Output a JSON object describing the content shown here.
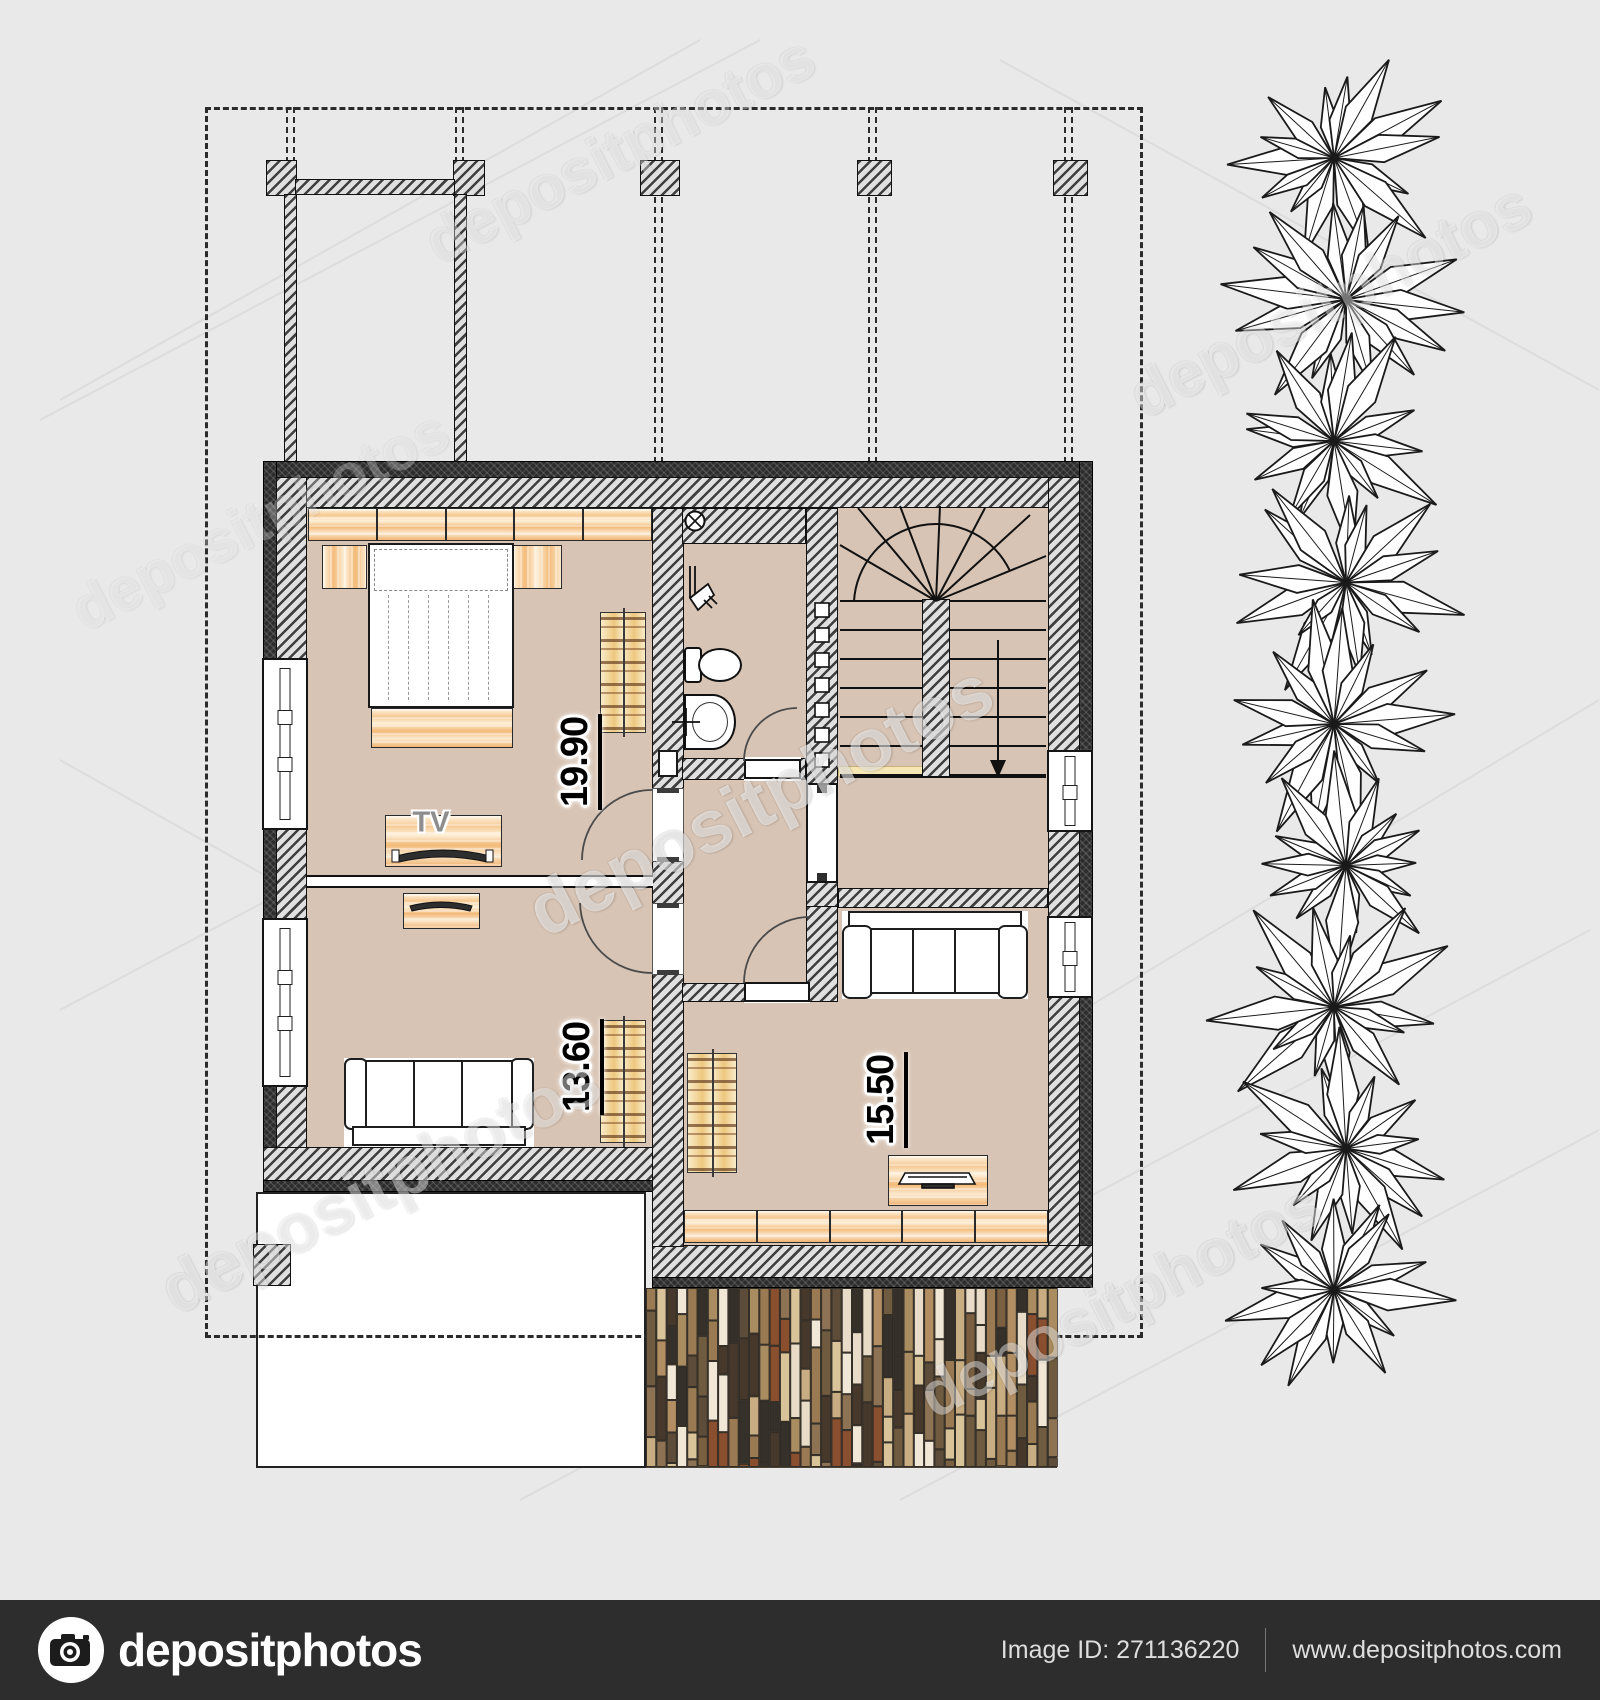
{
  "watermark": {
    "text": "depositphotos"
  },
  "floor_plan": {
    "rooms": [
      {
        "id": "room-top-left",
        "area": "19.90"
      },
      {
        "id": "room-bottom-left",
        "area": "13.60"
      },
      {
        "id": "room-bottom-right",
        "area": "15.50"
      }
    ],
    "tv_label": "TV"
  },
  "footer": {
    "brand": "depositphotos",
    "image_id": "Image ID: 271136220",
    "url": "www.depositphotos.com"
  },
  "colors": {
    "background": "#e9e9ea",
    "floor": "#d8c4b4",
    "wall_dark": "#2c2c2c",
    "wood": "#f3ba78",
    "footer_bar": "#2d2d2d"
  }
}
